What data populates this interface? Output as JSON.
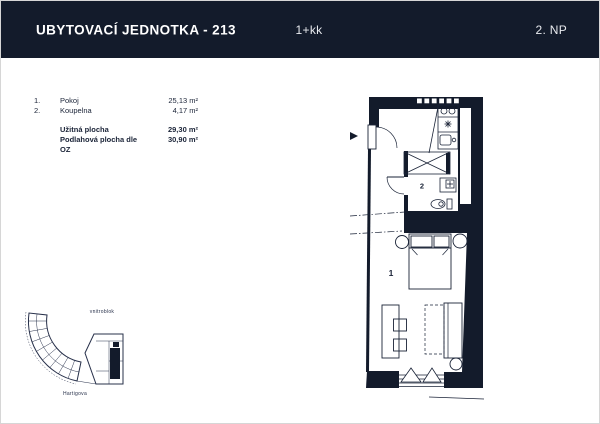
{
  "colors": {
    "navy_wall": "#131B2B",
    "line": "#1A2337",
    "header_bg": "#131B2B",
    "header_text": "#FFFFFF"
  },
  "header": {
    "title": "UBYTOVACÍ JEDNOTKA - 213",
    "layout": "1+kk",
    "floor": "2. NP"
  },
  "areas": {
    "rooms": [
      {
        "num": "1.",
        "name": "Pokoj",
        "area": "25,13 m²"
      },
      {
        "num": "2.",
        "name": "Koupelna",
        "area": "4,17 m²"
      }
    ],
    "totals": [
      {
        "name": "Užitná plocha",
        "area": "29,30 m²"
      },
      {
        "name": "Podlahová plocha dle OZ",
        "area": "30,90 m²"
      }
    ]
  },
  "plan": {
    "room_labels": [
      {
        "id": "1",
        "meaning": "Pokoj"
      },
      {
        "id": "2",
        "meaning": "Koupelna"
      }
    ]
  },
  "site": {
    "labels": {
      "courtyard": "vnitroblok",
      "street": "Hartigova"
    }
  }
}
